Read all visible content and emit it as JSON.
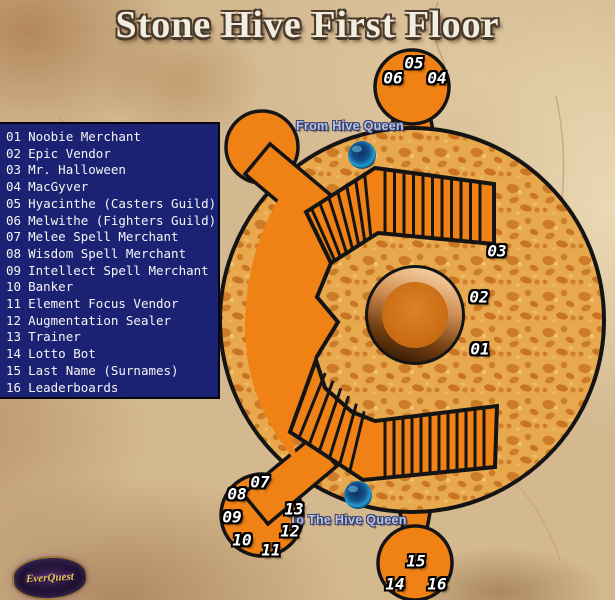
{
  "title": "Stone Hive First Floor",
  "legend": {
    "items": [
      {
        "num": "01",
        "name": "Noobie Merchant"
      },
      {
        "num": "02",
        "name": "Epic Vendor"
      },
      {
        "num": "03",
        "name": "Mr. Halloween"
      },
      {
        "num": "04",
        "name": "MacGyver"
      },
      {
        "num": "05",
        "name": "Hyacinthe (Casters Guild)"
      },
      {
        "num": "06",
        "name": "Melwithe (Fighters Guild)"
      },
      {
        "num": "07",
        "name": "Melee Spell Merchant"
      },
      {
        "num": "08",
        "name": "Wisdom Spell Merchant"
      },
      {
        "num": "09",
        "name": "Intellect Spell Merchant"
      },
      {
        "num": "10",
        "name": "Banker"
      },
      {
        "num": "11",
        "name": "Element Focus Vendor"
      },
      {
        "num": "12",
        "name": "Augmentation Sealer"
      },
      {
        "num": "13",
        "name": "Trainer"
      },
      {
        "num": "14",
        "name": "Lotto Bot"
      },
      {
        "num": "15",
        "name": "Last Name (Surnames)"
      },
      {
        "num": "16",
        "name": "Leaderboards"
      }
    ]
  },
  "map": {
    "from_label": "From Hive Queen",
    "to_label": "To The Hive Queen",
    "badges": [
      {
        "num": "01"
      },
      {
        "num": "02"
      },
      {
        "num": "03"
      },
      {
        "num": "04"
      },
      {
        "num": "05"
      },
      {
        "num": "06"
      },
      {
        "num": "07"
      },
      {
        "num": "08"
      },
      {
        "num": "09"
      },
      {
        "num": "10"
      },
      {
        "num": "11"
      },
      {
        "num": "12"
      },
      {
        "num": "13"
      },
      {
        "num": "14"
      },
      {
        "num": "15"
      },
      {
        "num": "16"
      }
    ]
  },
  "logo": {
    "text": "EverQuest"
  },
  "colors": {
    "floor_orange": "#ef8115",
    "texture_base": "#e8a94e",
    "texture_blob": "#cd7c27",
    "legend_bg": "#1b2273",
    "parchment": "#d3b890",
    "outline_black": "#141414",
    "sphere_blue": "#1f9ccf",
    "label_blue": "#b9c4e2"
  }
}
